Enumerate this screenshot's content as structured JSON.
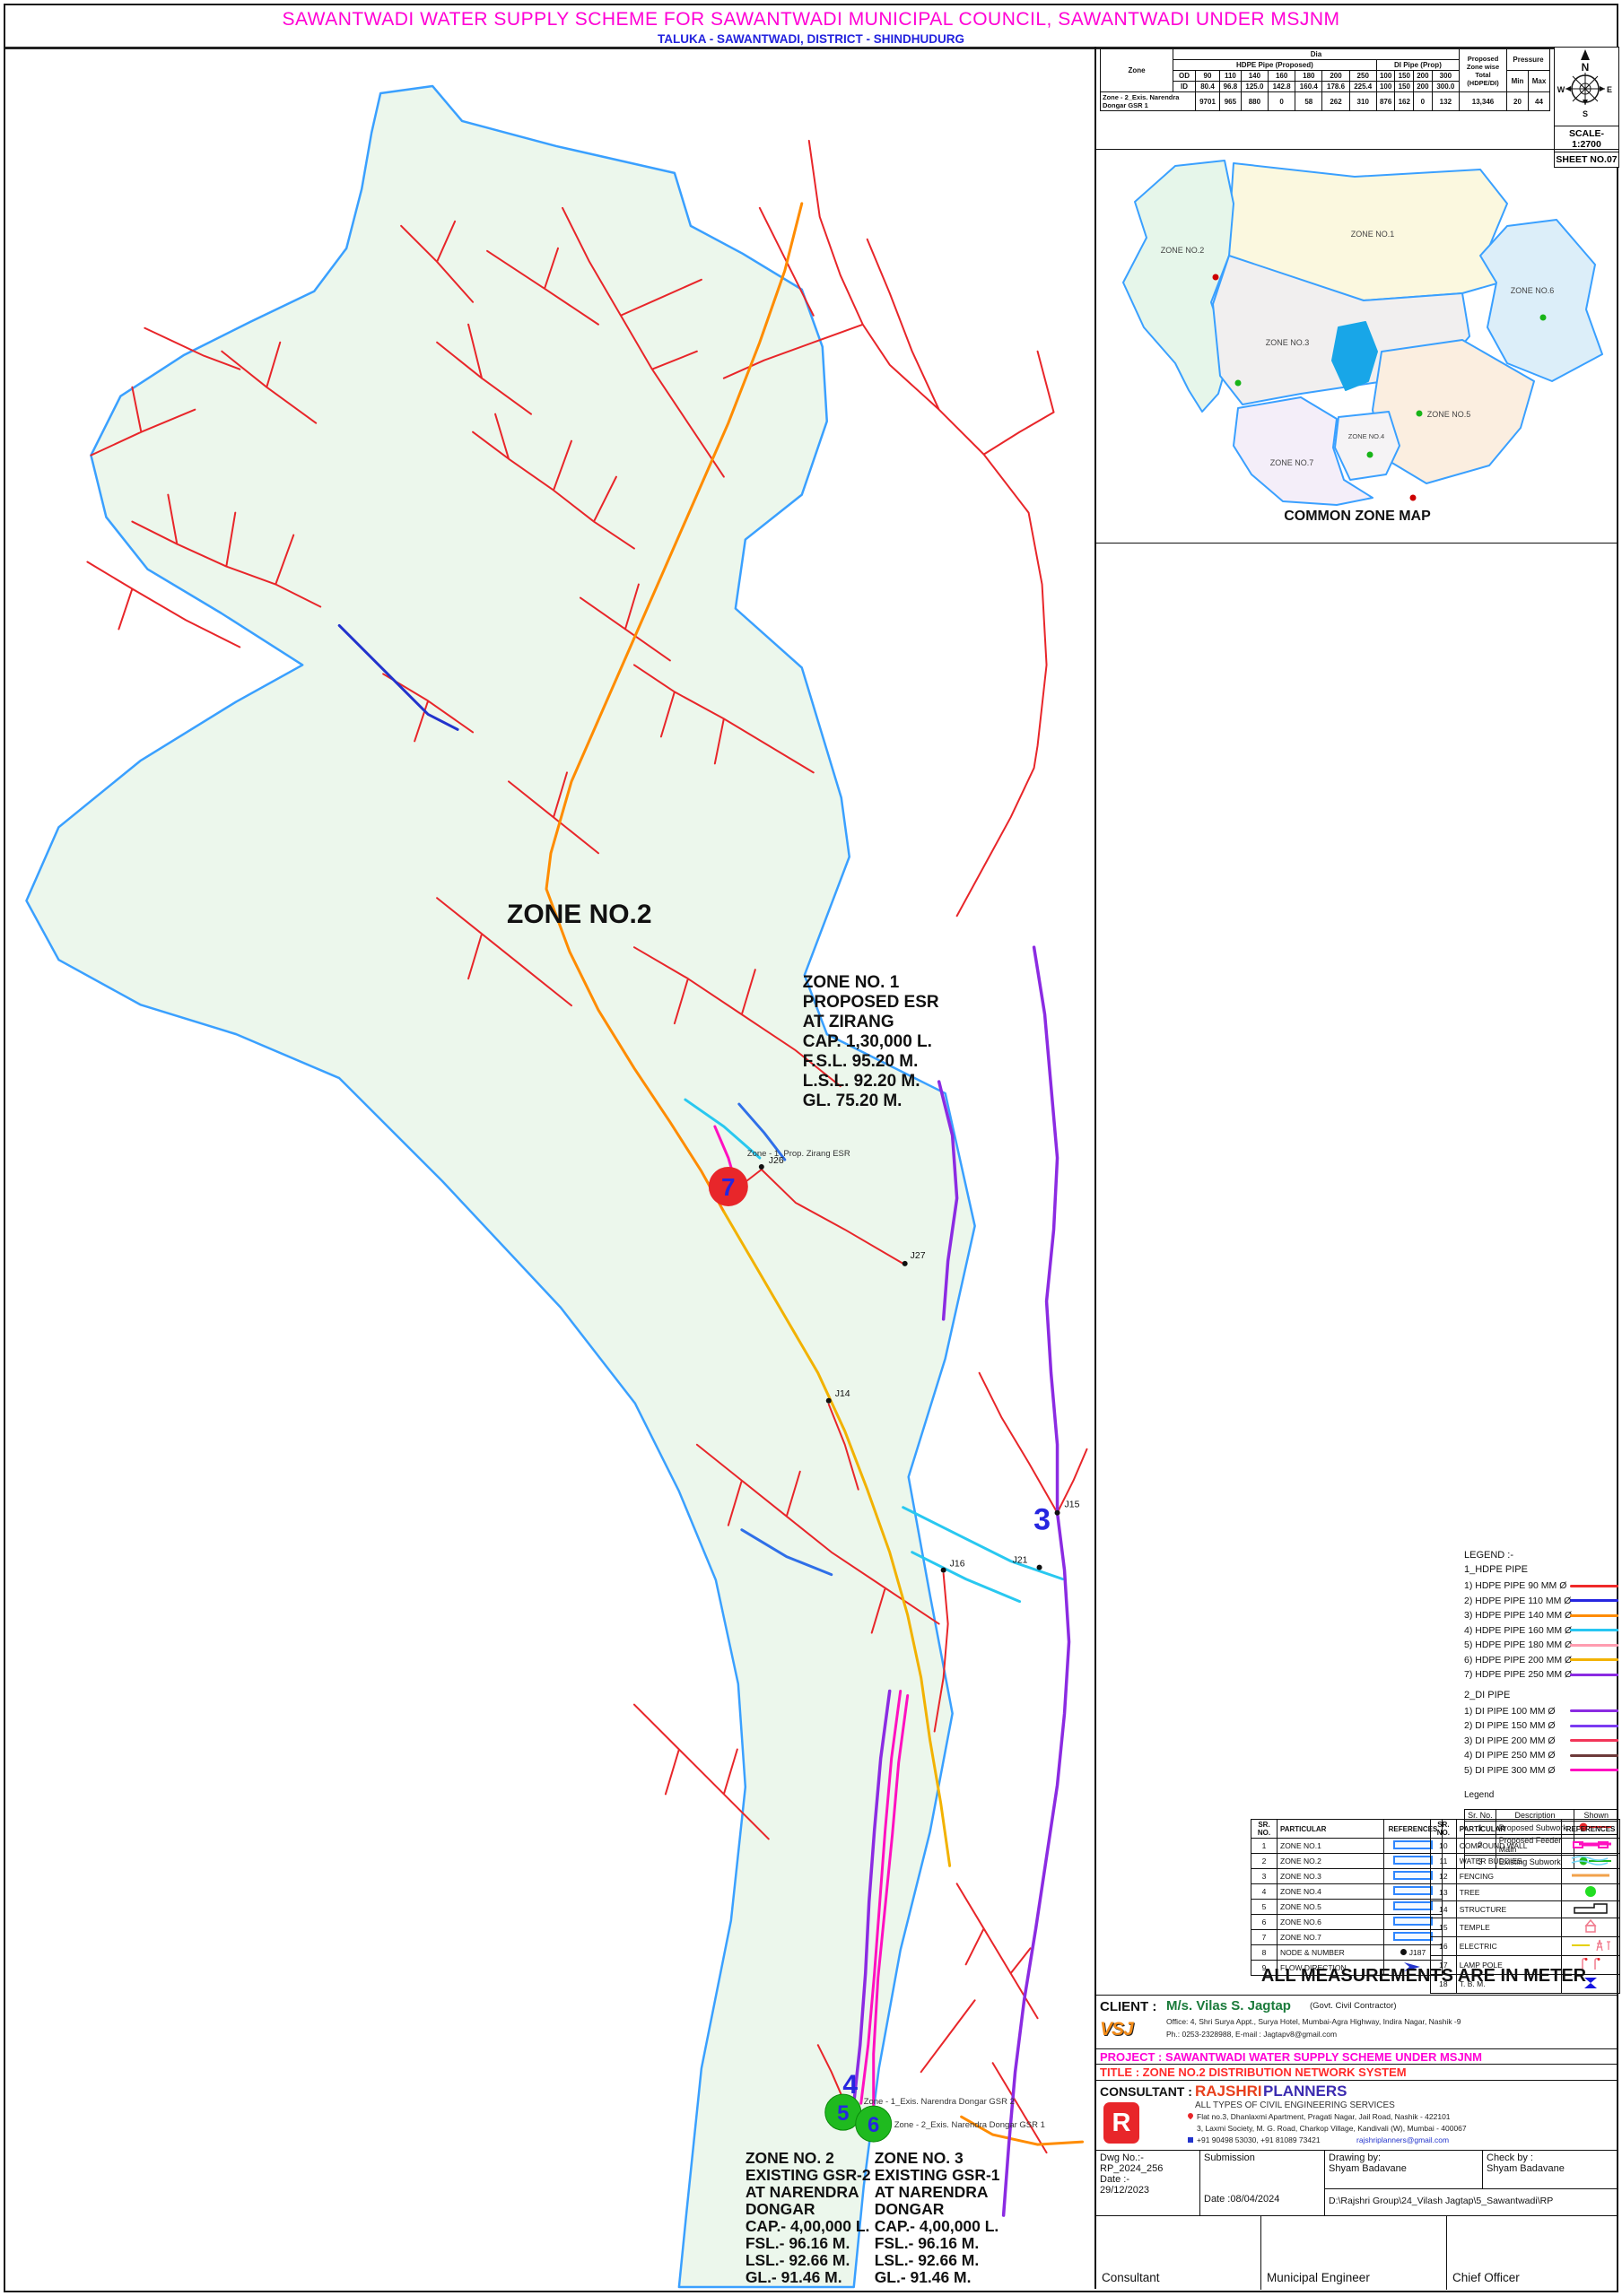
{
  "title_bar": {
    "title": "SAWANTWADI WATER SUPPLY SCHEME FOR SAWANTWADI MUNICIPAL COUNCIL, SAWANTWADI  UNDER MSJNM",
    "subtitle": "TALUKA - SAWANTWADI, DISTRICT - SHINDHUDURG"
  },
  "zone_table": {
    "zone_header": "Zone",
    "dia_header": "Dia",
    "hdpe_header": "HDPE Pipe (Proposed)",
    "di_header": "DI Pipe (Prop)",
    "total_header": "Proposed Zone wise Total (HDPE/DI)",
    "pressure_header": "Pressure",
    "od_label": "OD",
    "id_label": "ID",
    "min_label": "Min",
    "max_label": "Max",
    "od": [
      "90",
      "110",
      "140",
      "160",
      "180",
      "200",
      "250",
      "100",
      "150",
      "200",
      "300"
    ],
    "id": [
      "80.4",
      "96.8",
      "125.0",
      "142.8",
      "160.4",
      "178.6",
      "225.4",
      "100",
      "150",
      "200",
      "300.0"
    ],
    "row_label": "Zone - 2_Exis. Narendra Dongar GSR 1",
    "row_values": [
      "9701",
      "965",
      "880",
      "0",
      "58",
      "262",
      "310",
      "876",
      "162",
      "0",
      "132"
    ],
    "total": "13,346",
    "min": "20",
    "max": "44"
  },
  "compass": {
    "north": "N",
    "east": "E",
    "south": "S",
    "west": "W",
    "scale": "SCALE-1:2700",
    "sheet": "SHEET NO.07"
  },
  "common_zone_map": {
    "caption": "COMMON ZONE MAP",
    "zones": [
      "ZONE NO.1",
      "ZONE NO.2",
      "ZONE NO.3",
      "ZONE NO.4",
      "ZONE NO.5",
      "ZONE NO.6",
      "ZONE NO.7"
    ]
  },
  "map": {
    "zone_label": "ZONE NO.2",
    "esr_note": [
      "ZONE NO. 1",
      "PROPOSED ESR",
      "AT ZIRANG",
      "CAP.  1,30,000 L.",
      "F.S.L. 95.20 M.",
      "L.S.L. 92.20 M.",
      "GL.     75.20 M."
    ],
    "gsr2_note": [
      "ZONE NO. 2",
      "EXISTING GSR-2",
      "AT NARENDRA",
      "DONGAR",
      "CAP.- 4,00,000 L.",
      "FSL.- 96.16 M.",
      "LSL.- 92.66 M.",
      "GL.-  91.46 M."
    ],
    "gsr1_note": [
      "ZONE NO. 3",
      "EXISTING GSR-1",
      "AT NARENDRA",
      "DONGAR",
      "CAP.- 4,00,000 L.",
      "FSL.- 96.16 M.",
      "LSL.- 92.66 M.",
      "GL.-  91.46 M."
    ],
    "markers": {
      "m3": "3",
      "m4": "4",
      "m5": "5",
      "m6": "6",
      "m7": "7"
    },
    "nodes": {
      "j14": "J14",
      "j15": "J15",
      "j16": "J16",
      "j21": "J21",
      "j26": "J26",
      "j27": "J27"
    },
    "tiny_labels": {
      "esr": "Zone - 1_Prop. Zirang ESR",
      "gsr2": "Zone - 1_Exis. Narendra Dongar GSR 2",
      "gsr1": "Zone - 2_Exis. Narendra Dongar GSR 1"
    }
  },
  "legend": {
    "heading": "LEGEND :-",
    "hdpe_heading": "1_HDPE PIPE",
    "hdpe": [
      {
        "label": "1) HDPE PIPE  90 MM Ø",
        "color": "#ef2929"
      },
      {
        "label": "2) HDPE PIPE 110 MM Ø",
        "color": "#2626e0"
      },
      {
        "label": "3) HDPE PIPE 140 MM Ø",
        "color": "#ff8c00"
      },
      {
        "label": "4) HDPE PIPE 160 MM Ø",
        "color": "#27c6f2"
      },
      {
        "label": "5) HDPE PIPE 180 MM Ø",
        "color": "#ff9db0"
      },
      {
        "label": "6) HDPE PIPE 200 MM Ø",
        "color": "#f2b200"
      },
      {
        "label": "7) HDPE PIPE 250 MM Ø",
        "color": "#8b2be2"
      }
    ],
    "di_heading": "2_DI PIPE",
    "di": [
      {
        "label": "1) DI PIPE 100 MM Ø",
        "color": "#8b2be2"
      },
      {
        "label": "2) DI PIPE 150 MM Ø",
        "color": "#7b3bf2"
      },
      {
        "label": "3) DI PIPE 200 MM Ø",
        "color": "#f23558"
      },
      {
        "label": "4) DI PIPE 250 MM Ø",
        "color": "#6d3a3a"
      },
      {
        "label": "5) DI PIPE 300 MM Ø",
        "color": "#ff10c0"
      }
    ]
  },
  "legend_table": {
    "title": "Legend",
    "headers": [
      "Sr. No.",
      "Description",
      "Shown"
    ],
    "rows": [
      {
        "no": "1",
        "desc": "Proposed Subwork"
      },
      {
        "no": "2",
        "desc": "Proposed Feeder Main"
      },
      {
        "no": "3",
        "desc": "Existing Subwork"
      }
    ]
  },
  "ref_table": {
    "sr_header": "SR. NO.",
    "particular_header": "PARTICULAR",
    "references_header": "REFERENCES",
    "left": [
      {
        "no": "1",
        "name": "ZONE NO.1"
      },
      {
        "no": "2",
        "name": "ZONE NO.2"
      },
      {
        "no": "3",
        "name": "ZONE NO.3"
      },
      {
        "no": "4",
        "name": "ZONE NO.4"
      },
      {
        "no": "5",
        "name": "ZONE NO.5"
      },
      {
        "no": "6",
        "name": "ZONE NO.6"
      },
      {
        "no": "7",
        "name": "ZONE NO.7"
      },
      {
        "no": "8",
        "name": "NODE & NUMBER",
        "ref_text": "J187"
      },
      {
        "no": "9",
        "name": "FLOW DIRECTION"
      }
    ],
    "right": [
      {
        "no": "10",
        "name": "COMPOUND WALL"
      },
      {
        "no": "11",
        "name": "WATER BUDDIES"
      },
      {
        "no": "12",
        "name": "FENCING"
      },
      {
        "no": "13",
        "name": "TREE"
      },
      {
        "no": "14",
        "name": "STRUCTURE"
      },
      {
        "no": "15",
        "name": "TEMPLE"
      },
      {
        "no": "16",
        "name": "ELECTRIC"
      },
      {
        "no": "17",
        "name": "LAMP POLE"
      },
      {
        "no": "18",
        "name": "T. B. M."
      }
    ]
  },
  "measure_note": "ALL MEASUREMENTS ARE IN METER",
  "title_block": {
    "client_label": "CLIENT :",
    "client_name": "M/s. Vilas S. Jagtap",
    "client_suffix": "(Govt. Civil Contractor)",
    "client_office": "Office: 4, Shri Surya Appt., Surya Hotel, Mumbai-Agra Highway, Indira Nagar, Nashik -9",
    "client_phone": "Ph.: 0253-2328988, E-mail : Jagtapv8@gmail.com",
    "client_logo": "VSJ",
    "project": "PROJECT : SAWANTWADI WATER SUPPLY SCHEME UNDER MSJNM",
    "title": "TITLE : ZONE NO.2 DISTRIBUTION NETWORK SYSTEM",
    "consultant_label": "CONSULTANT :",
    "consultant_name_1": "RAJSHRI",
    "consultant_name_2": "PLANNERS",
    "consultant_logo": "R",
    "consultant_tagline": "ALL TYPES OF CIVIL ENGINEERING SERVICES",
    "consultant_addr1": "Flat no.3, Dhanlaxmi Apartment, Pragati Nagar, Jail Road, Nashik - 422101",
    "consultant_addr2": "3, Laxmi Society, M. G. Road, Charkop Village, Kandivali (W), Mumbai - 400067",
    "consultant_phone": "+91 90498 53030, +91 81089 73421",
    "consultant_email": "rajshriplanners@gmail.com",
    "dwg_no_label": "Dwg No.:-",
    "dwg_no": "RP_2024_256",
    "date_label": "Date :-",
    "date": "29/12/2023",
    "submission": "Submission",
    "submission_date": "Date :08/04/2024",
    "drawing_by_label": "Drawing by:",
    "drawing_by": "Shyam Badavane",
    "check_by_label": "Check by :",
    "check_by": "Shyam Badavane",
    "file_path": "D:\\Rajshri Group\\24_Vilash Jagtap\\5_Sawantwadi\\RP",
    "sign_consultant": "Consultant",
    "sign_engineer": "Municipal Engineer",
    "sign_officer": "Chief Officer"
  }
}
